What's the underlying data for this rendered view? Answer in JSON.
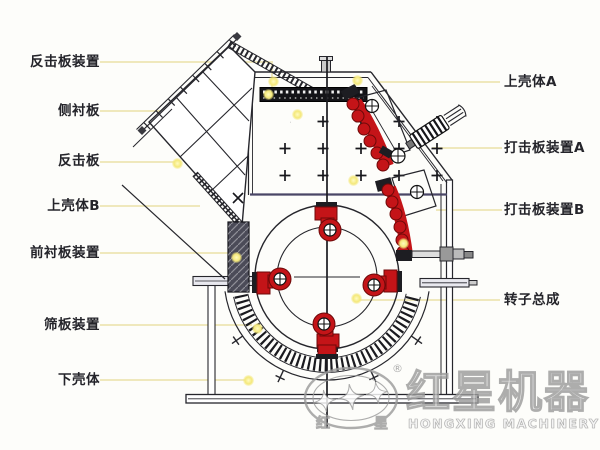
{
  "labels": {
    "left": [
      {
        "text": "反击板装置"
      },
      {
        "text": "侧衬板"
      },
      {
        "text": "反击板"
      },
      {
        "text": "上壳体B"
      },
      {
        "text": "前衬板装置"
      },
      {
        "text": "筛板装置"
      },
      {
        "text": "下壳体"
      }
    ],
    "right": [
      {
        "text": "上壳体A"
      },
      {
        "text": "打击板装置A"
      },
      {
        "text": "打击板装置B"
      },
      {
        "text": "转子总成"
      }
    ]
  },
  "watermark": {
    "brand_cn": "红星机器",
    "brand_en": "HONGXING MACHINERY",
    "seal_left_cn": "红",
    "seal_right_cn": "星",
    "registered_mark": "®"
  },
  "highlight_dots": [
    [
      273,
      81
    ],
    [
      297,
      114
    ],
    [
      357,
      80
    ],
    [
      268,
      94
    ],
    [
      353,
      180
    ],
    [
      177,
      163
    ],
    [
      403,
      243
    ],
    [
      356,
      298
    ],
    [
      236,
      257
    ],
    [
      257,
      328
    ],
    [
      248,
      380
    ]
  ],
  "colors": {
    "background": "#fdfdfa",
    "line_dark": "#26262c",
    "navy_divider": "#4a4666",
    "impact_plate_red": "#c41418",
    "liner_dark": "#4b4b58",
    "leader_line": "#efe8bc",
    "highlight_dot": "#f4e87a",
    "watermark_gray": "#9c9c9c"
  }
}
